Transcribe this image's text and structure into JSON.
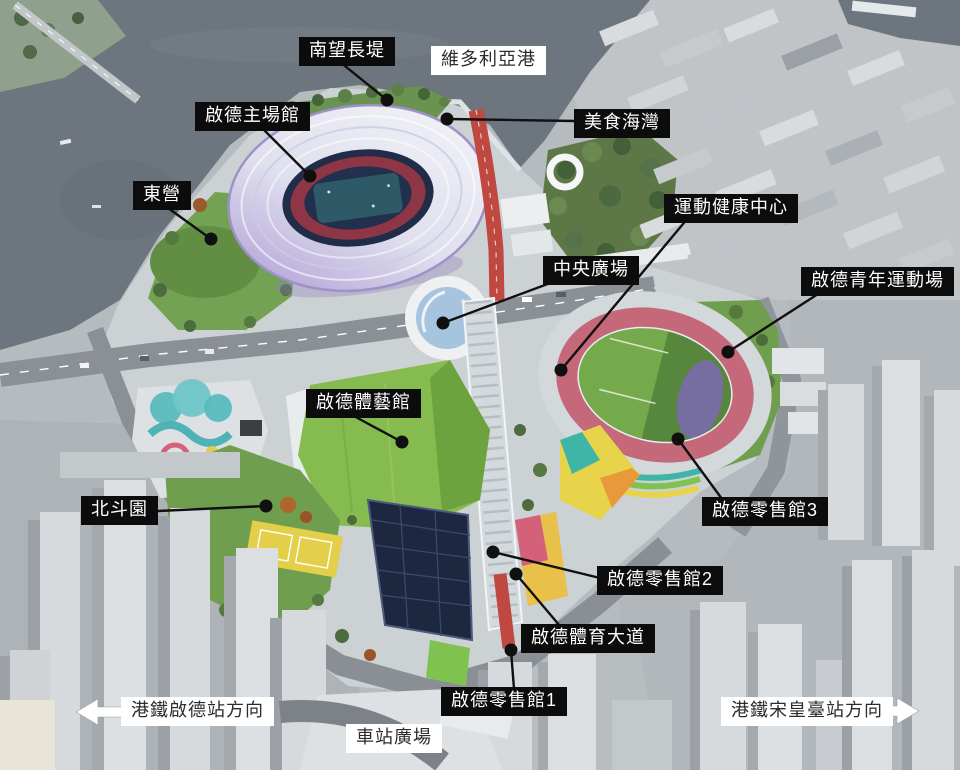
{
  "labels": [
    {
      "text": "南望長堤",
      "style": "dark"
    },
    {
      "text": "維多利亞港",
      "style": "light"
    },
    {
      "text": "啟德主場館",
      "style": "dark"
    },
    {
      "text": "美食海灣",
      "style": "dark"
    },
    {
      "text": "東營",
      "style": "dark"
    },
    {
      "text": "運動健康中心",
      "style": "dark"
    },
    {
      "text": "中央廣場",
      "style": "dark"
    },
    {
      "text": "啟德青年運動場",
      "style": "dark"
    },
    {
      "text": "啟德體藝館",
      "style": "dark"
    },
    {
      "text": "北斗園",
      "style": "dark"
    },
    {
      "text": "啟德零售館3",
      "style": "dark"
    },
    {
      "text": "啟德零售館2",
      "style": "dark"
    },
    {
      "text": "啟德體育大道",
      "style": "dark"
    },
    {
      "text": "啟德零售館1",
      "style": "dark"
    },
    {
      "text": "港鐵啟德站方向",
      "style": "light",
      "icon": "arrow-left"
    },
    {
      "text": "車站廣場",
      "style": "light"
    },
    {
      "text": "港鐵宋皇臺站方向",
      "style": "light",
      "icon": "arrow-right"
    }
  ],
  "colors": {
    "label_dark_bg": "#0c0c0c",
    "label_light_bg": "#ffffff",
    "water": "#6d767e",
    "stadium_roof_light": "#f4f5f8",
    "stadium_roof_purple": "#bcabdb",
    "lawn_green": "#6f9e4f",
    "track_pink": "#c4687a",
    "avenue_red": "#bf4840",
    "solar_roof_navy": "#1d2840"
  }
}
